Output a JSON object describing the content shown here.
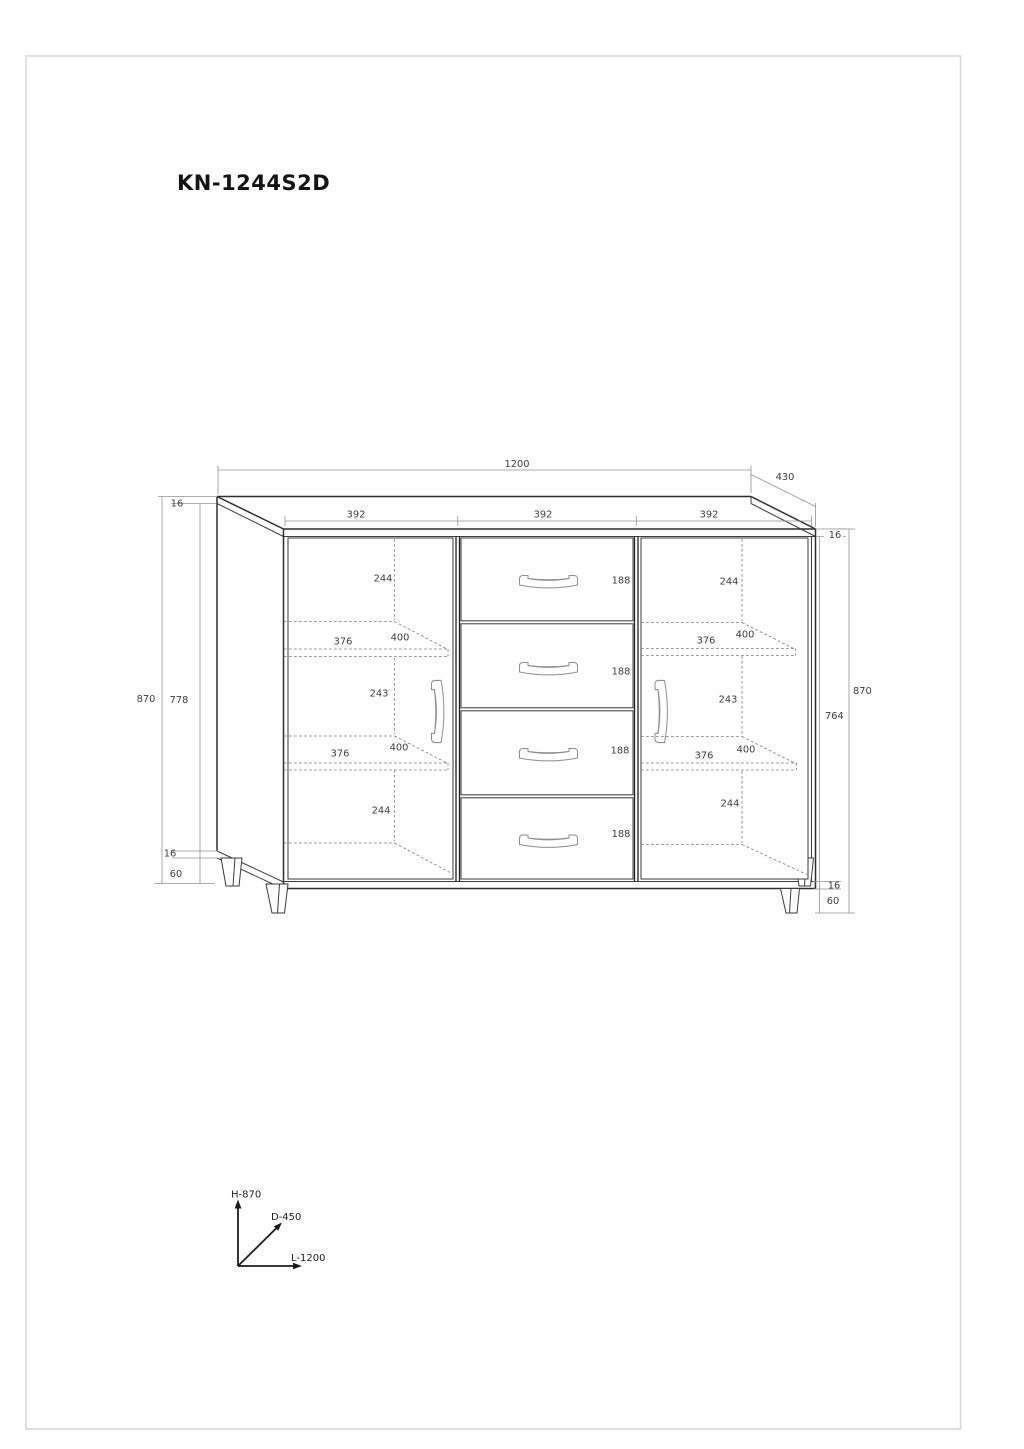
{
  "title": "KN-1244S2D",
  "dims": {
    "top": {
      "width": "1200",
      "depth": "430",
      "sections": [
        "392",
        "392",
        "392"
      ],
      "left_panel_thickness": "16",
      "top_panel_thickness": "16"
    },
    "left_side": {
      "overall_height": "870",
      "interior_height": "778",
      "bottom_panel": "16",
      "leg_height": "60"
    },
    "right_side": {
      "overall_height": "870",
      "front_height": "764",
      "bottom_panel": "16",
      "leg_height": "60"
    },
    "drawers": {
      "heights": [
        "188",
        "188",
        "188",
        "188"
      ]
    },
    "left_compartment": {
      "space_top": "244",
      "shelf1_width": "376",
      "shelf1_depth": "400",
      "space_middle": "243",
      "shelf2_width": "376",
      "shelf2_depth": "400",
      "space_bottom": "244"
    },
    "right_compartment": {
      "space_top": "244",
      "shelf1_width": "376",
      "shelf1_depth": "400",
      "space_middle": "243",
      "shelf2_width": "376",
      "shelf2_depth": "400",
      "space_bottom": "244"
    },
    "axes": {
      "height": "H-870",
      "depth": "D-450",
      "length": "L-1200"
    }
  }
}
